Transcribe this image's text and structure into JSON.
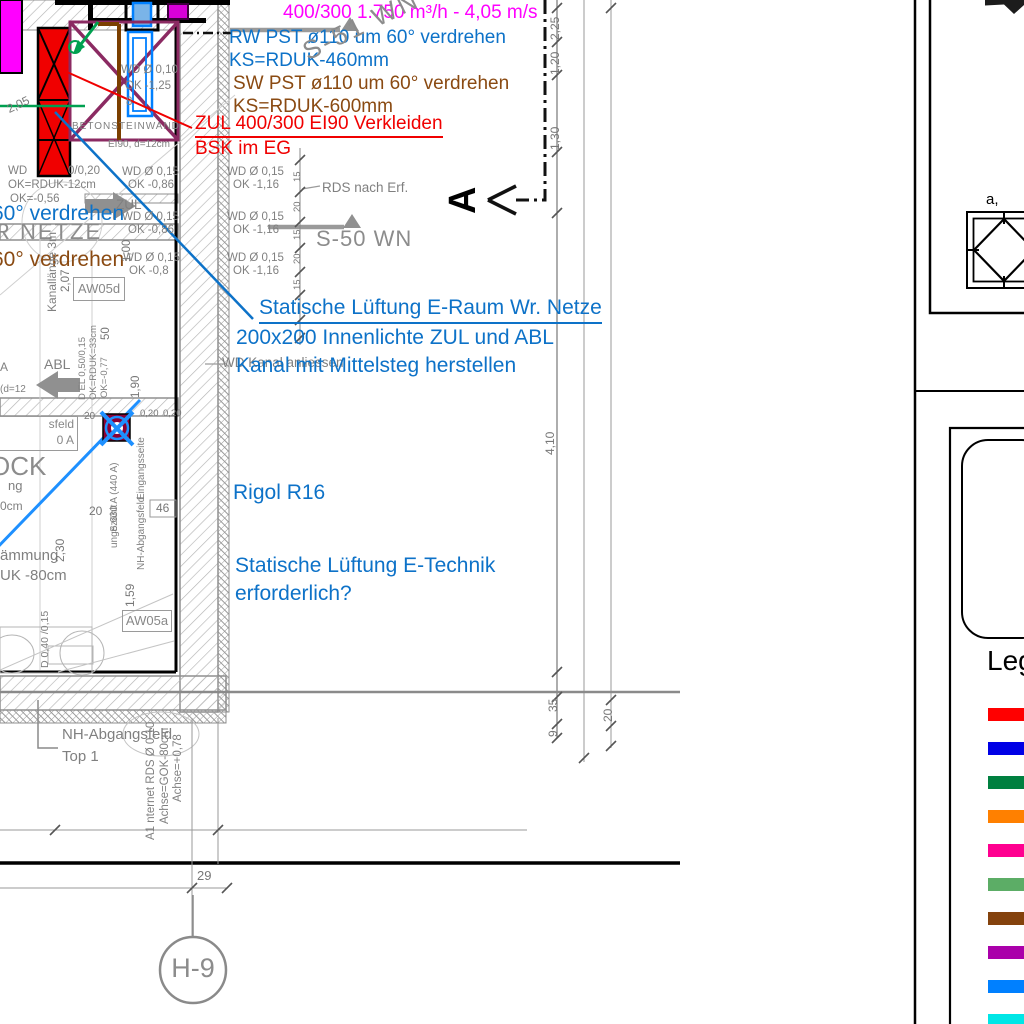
{
  "callouts": {
    "airflow": "400/300 1.750 m³/h - 4,05 m/s",
    "rw1": "RW PST ø110 um 60° verdrehen",
    "rw2": "KS=RDUK-460mm",
    "sw1": "SW PST ø110 um 60° verdrehen",
    "sw2": "KS=RDUK-600mm",
    "zul_ei90": "ZUL 400/300 EI90 Verkleiden",
    "bsk": "BSK im EG",
    "eraum1": "Statische Lüftung E-Raum Wr. Netze",
    "eraum2": "200x200 Innenlichte ZUL und ABL",
    "eraum3": "Kanal mit Mittelsteg herstellen",
    "rigol": "Rigol R16",
    "etech1": "Statische Lüftung E-Technik",
    "etech2": "erforderlich?",
    "verdrehen_blue": "60° verdrehen",
    "verdrehen_brown": "60° verdrehen",
    "wd_kanal": "WD Kanal anliessen"
  },
  "labels": {
    "s51": "S-51 WN",
    "s50": "S-50 WN",
    "rds": "RDS nach Erf.",
    "section_a": "A",
    "zul": "ZUL",
    "abl": "ABL",
    "wr_netze": "R NETZE",
    "ock": "OCK",
    "beton": "BETONSTEINWAND",
    "ei90": "EI90, d=12cm",
    "aw05d": "AW05d",
    "aw05a": "AW05a",
    "sfeld1": "sfeld",
    "sfeld2": "0 A",
    "kanallaenge": "Kanallänge 3m",
    "s630": "S 630 A (440 A)",
    "eingang": "Eingangsseite",
    "ungezaehlt": "ungezählt",
    "nh_vert": "NH-Abgangsfeld",
    "daemmung": "ämmung",
    "uk80": "UK -80cm",
    "ng": "ng",
    "cm0": "0cm",
    "a_cut": "A",
    "d12_cut": "(d=12",
    "nh1": "NH-Abgangsfeld",
    "nh2": "Top 1",
    "a1_internet": "A1  nternet RDS Ø 0,10",
    "achse_gok": "Achse=GOK-80cm",
    "achse_078": "Achse=+0,78",
    "h9": "H-9",
    "legende": "Legende",
    "a_comma": "a,",
    "wd": "WD",
    "ok_rduk": "OK=RDUK-12cm",
    "ok056": "OK=-0,56",
    "frac0020": "0/0,20",
    "wd010": "WD Ø 0,10",
    "ok125": "OK -1,25",
    "eight": "8",
    "e_do": "D 0,40 /0,15"
  },
  "wd_notes": [
    {
      "wd": "WD Ø 0,15",
      "ok": "OK -0,86"
    },
    {
      "wd": "WD Ø 0,15",
      "ok": "OK -0,86"
    },
    {
      "wd": "WD Ø 0,15",
      "ok": "OK -0,8"
    },
    {
      "wd": "WD Ø 0,15",
      "ok": "OK -1,16"
    },
    {
      "wd": "WD Ø 0,15",
      "ok": "OK -1,16"
    },
    {
      "wd": "WD Ø 0,15",
      "ok": "OK -1,16"
    }
  ],
  "dims": {
    "v225": "2,25",
    "v120": "1,20",
    "v130": "1,30",
    "v410": "4,10",
    "v35": "35",
    "v9": "9",
    "v20": "20",
    "v29": "29",
    "v100": "1,00",
    "v207": "2,07",
    "v50": "50",
    "v190": "1,90",
    "v159": "1,59",
    "v230": "2,30",
    "v46": "46",
    "v20b": "20",
    "v020a": "0,20",
    "v020b": "0,20",
    "v205": "2,05",
    "chain": [
      "15",
      "20",
      "15",
      "20",
      "15"
    ]
  },
  "legend": {
    "title": "Legende",
    "colors": [
      "#ff0000",
      "#0000e6",
      "#008040",
      "#ff8000",
      "#ff0090",
      "#5cad66",
      "#84420d",
      "#aa00aa",
      "#0080ff",
      "#00e6e6"
    ]
  }
}
